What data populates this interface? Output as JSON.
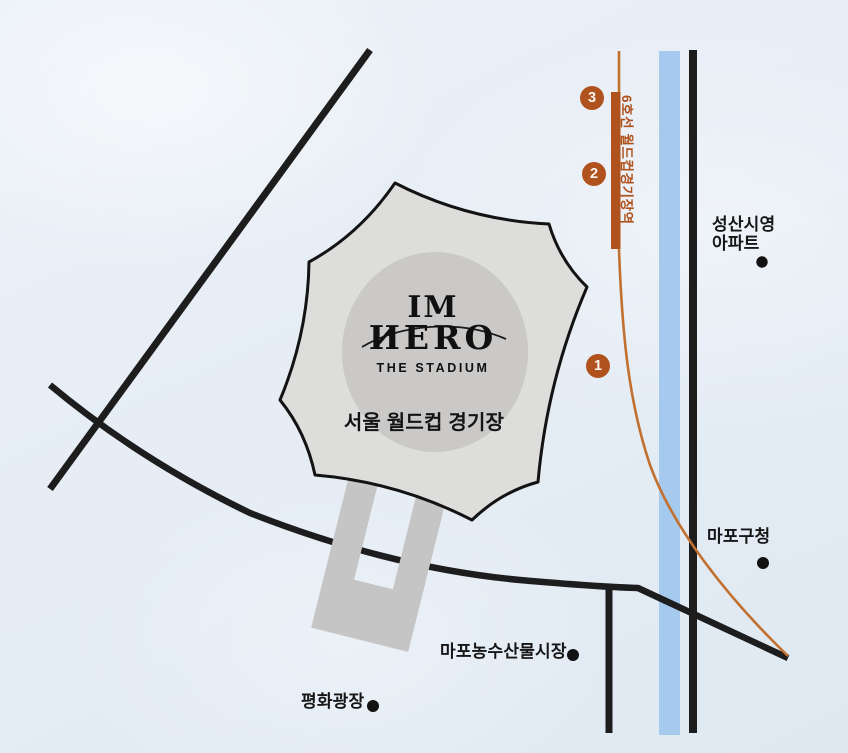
{
  "stadium": {
    "logo_top": "IM",
    "logo_main": "ИERO",
    "logo_sub": "THE STADIUM",
    "name": "서울 월드컵 경기장"
  },
  "subway": {
    "station_label": "6호선 월드컵경기장역",
    "exits": [
      {
        "number": "1"
      },
      {
        "number": "2"
      },
      {
        "number": "3"
      }
    ]
  },
  "pois": [
    {
      "id": "seongsan-apartment",
      "label_line1": "성산시영",
      "label_line2": "아파트"
    },
    {
      "id": "mapo-gu-office",
      "label": "마포구청"
    },
    {
      "id": "mapo-market",
      "label": "마포농수산물시장"
    },
    {
      "id": "peace-plaza",
      "label": "평화광장"
    }
  ],
  "colors": {
    "background": "#e6edf5",
    "road": "#1d1d1d",
    "water": "#a6c9ee",
    "stadium_fill": "#dddddc",
    "stadium_inner": "#cac9c8",
    "walkway": "#c5c5c5",
    "accent_orange": "#b0521d",
    "route_orange": "#c2702f",
    "poi_dot": "#121212"
  }
}
